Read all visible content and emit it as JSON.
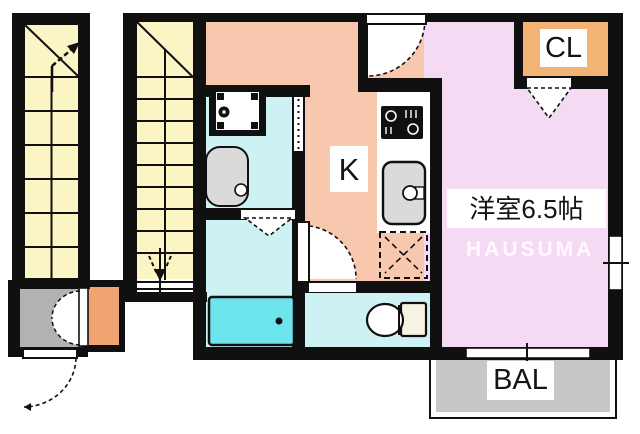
{
  "image_type": "apartment-floor-plan",
  "rooms": {
    "kitchen": {
      "label": "K",
      "color": "#F7C7AE"
    },
    "western_room": {
      "label": "洋室6.5帖",
      "color": "#F5DAF3"
    },
    "closet": {
      "label": "CL",
      "color": "#F2B375"
    },
    "balcony": {
      "label": "BAL",
      "color": "#C7C7C7"
    },
    "washroom": {
      "color": "#CDF2F4"
    },
    "bathroom": {
      "color": "#CDF2F4"
    },
    "toilet_room": {
      "color": "#CDF2F4"
    },
    "staircases": {
      "color": "#FBF4C4"
    },
    "entrance": {
      "color": "#B2B2B2"
    }
  },
  "watermark": {
    "text": "HAUSUMA"
  },
  "fixtures": [
    "bathtub",
    "toilet",
    "washing-machine-pan",
    "wash-basin",
    "gas-stove",
    "kitchen-sink",
    "refrigerator-space",
    "stair-up-arrow",
    "stair-down-arrow",
    "entry-door",
    "toilet-door",
    "entrance-door",
    "double-door",
    "closet-folding-door",
    "bath-folding-door",
    "window-right",
    "sliding-window-balcony"
  ],
  "palette": {
    "wall": "#101010",
    "bathtub": "#6EE4EC",
    "counter": "#FFFFFF"
  }
}
